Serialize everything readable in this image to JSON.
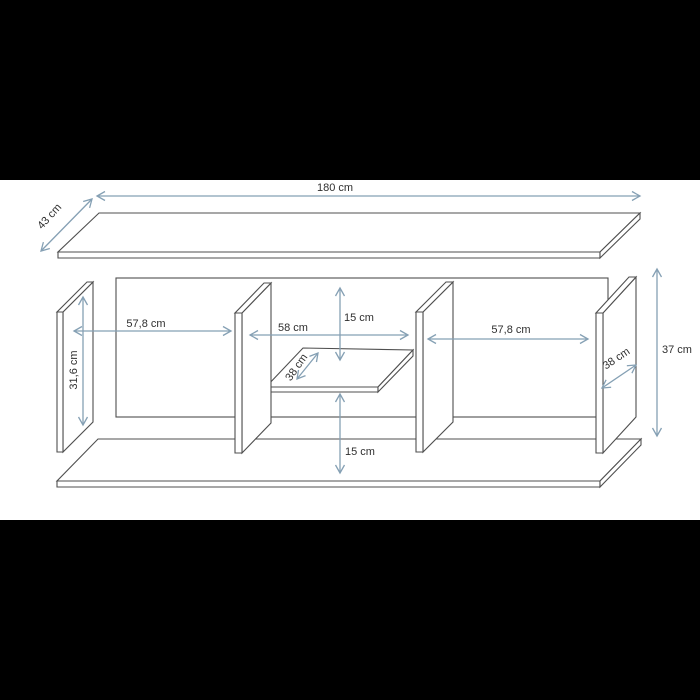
{
  "colors": {
    "letterbox": "#000000",
    "paper": "#ffffff",
    "drawing_line": "#4f4f4f",
    "dimension_line": "#85a0b4",
    "label_text": "#2f2f2f"
  },
  "diagram": {
    "kind": "furniture-dimension-drawing",
    "units": "cm",
    "dimensions": {
      "top_width": {
        "label": "180 cm",
        "value": 180
      },
      "top_depth": {
        "label": "43 cm",
        "value": 43
      },
      "left_width": {
        "label": "57,8 cm",
        "value": 57.8
      },
      "left_height": {
        "label": "31,6 cm",
        "value": 31.6
      },
      "center_width": {
        "label": "58 cm",
        "value": 58
      },
      "center_top_gap": {
        "label": "15 cm",
        "value": 15
      },
      "shelf_depth": {
        "label": "38 cm",
        "value": 38
      },
      "right_width": {
        "label": "57,8 cm",
        "value": 57.8
      },
      "side_depth": {
        "label": "38 cm",
        "value": 38
      },
      "total_height": {
        "label": "37 cm",
        "value": 37
      },
      "center_bottom_gap": {
        "label": "15 cm",
        "value": 15
      }
    }
  }
}
